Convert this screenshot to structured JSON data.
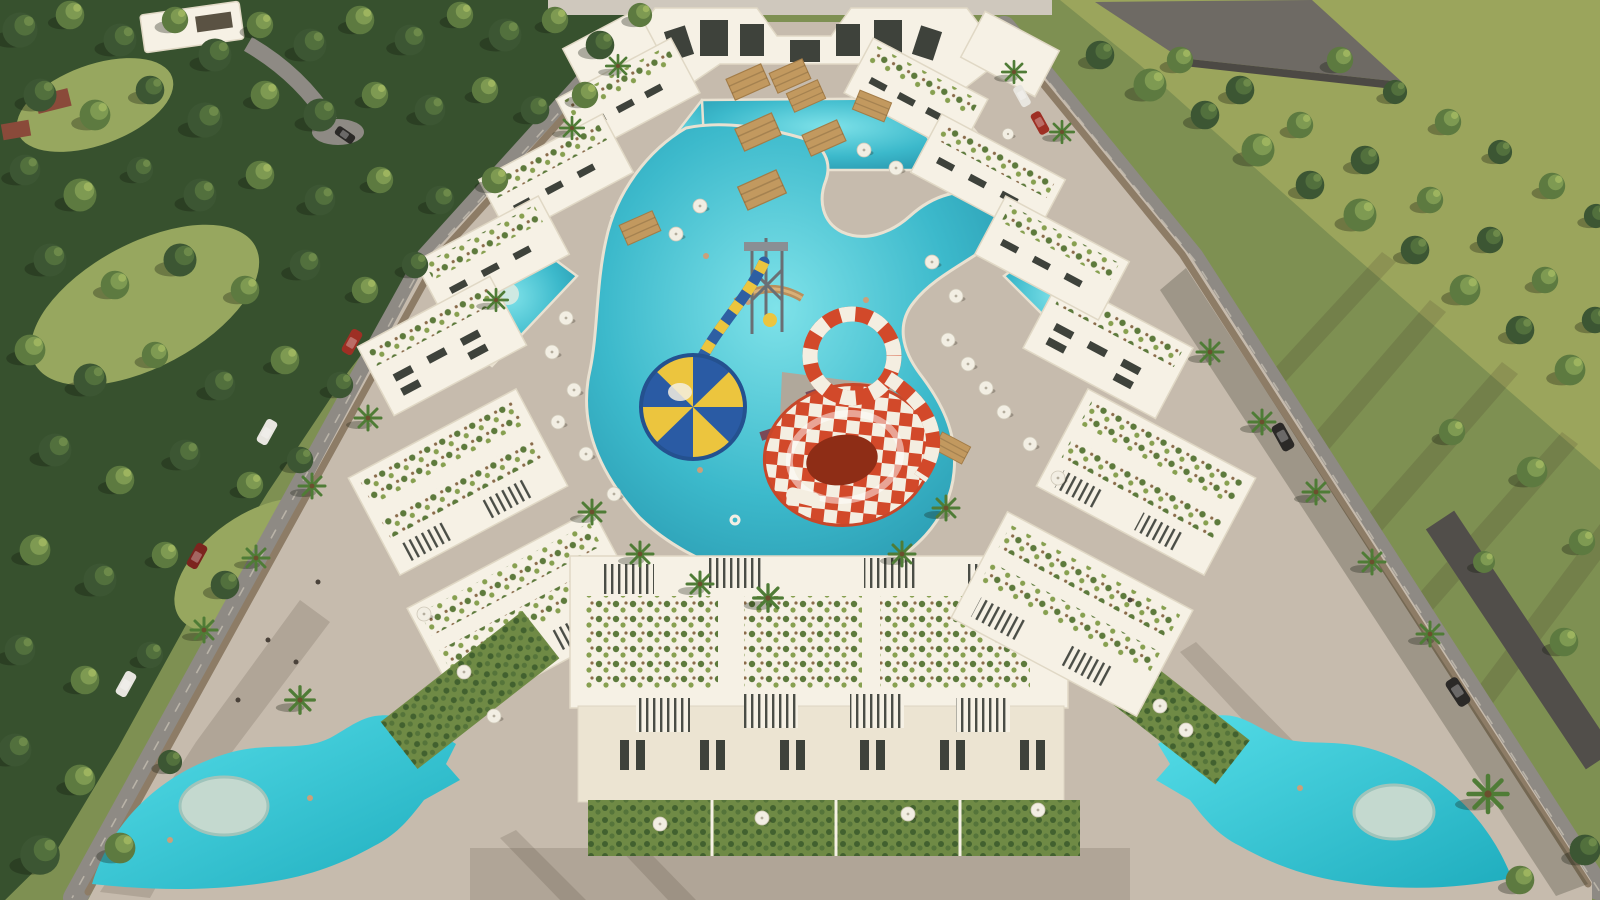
{
  "type": "architectural-aerial-render",
  "scene": {
    "elements": [
      "left-forest",
      "right-meadow",
      "olive-field",
      "warehouse-roof",
      "villa",
      "perimeter-wall",
      "left-road",
      "right-road",
      "parked-cars",
      "plaza",
      "left-plaza-pool",
      "right-plaza-pool",
      "pool-islands",
      "central-lagoon-pool",
      "upper-pool-channels",
      "courtyard-pools",
      "funnel-slide",
      "tube-ring-slide",
      "balloon-funnel-slide",
      "slide-tower",
      "wooden-bridge",
      "clubhouse",
      "apartment-blocks",
      "roof-garden-blocks",
      "townhouse-row",
      "front-gardens",
      "pergolas",
      "palm-trees",
      "pool-umbrellas",
      "sun-loungers",
      "swimmers"
    ]
  },
  "colors": {
    "grass": "#7e9052",
    "grass_light": "#97a75f",
    "field_olive": "#9ba55c",
    "forest_base": "#37512e",
    "pine_dark": "#3c5633",
    "pine_mid": "#52703d",
    "pine_hl": "#6d8a4a",
    "palm": "#4f7c36",
    "plaza": "#c6bbad",
    "plaza_light": "#cfc5b7",
    "road": "#8e8a84",
    "asphalt": "#514e4a",
    "wall": "#8d7c66",
    "building_white": "#f6f1e5",
    "building_shade": "#e0d8c5",
    "building_face": "#ece4d2",
    "window_dark": "#3e423b",
    "pool_deep": "#2490a8",
    "pool_mid": "#3cb9cb",
    "pool_light": "#74dce4",
    "plaza_pool": "#38cad8",
    "plaza_pool_deep": "#1fadbe",
    "island": "#c4d9cf",
    "slide_red": "#d2492a",
    "slide_white": "#f4eee1",
    "funnel_core": "#8e2d16",
    "balloon_yellow": "#ecc53e",
    "balloon_blue": "#2a5ba4",
    "tube_blue": "#2e5fa3",
    "pergola": "#c2995f",
    "lounger": "#7a4a58",
    "umbrella": "#f2eee3",
    "roof_grey": "#6e6a64",
    "car_red": "#9e2f24",
    "car_white": "#e8e6e0",
    "car_dark": "#2b2927",
    "car_darkred": "#7c241e",
    "cottage_roof": "#8a4a3a",
    "hedge": "#42612f",
    "garden_green": "#6f8a45"
  }
}
